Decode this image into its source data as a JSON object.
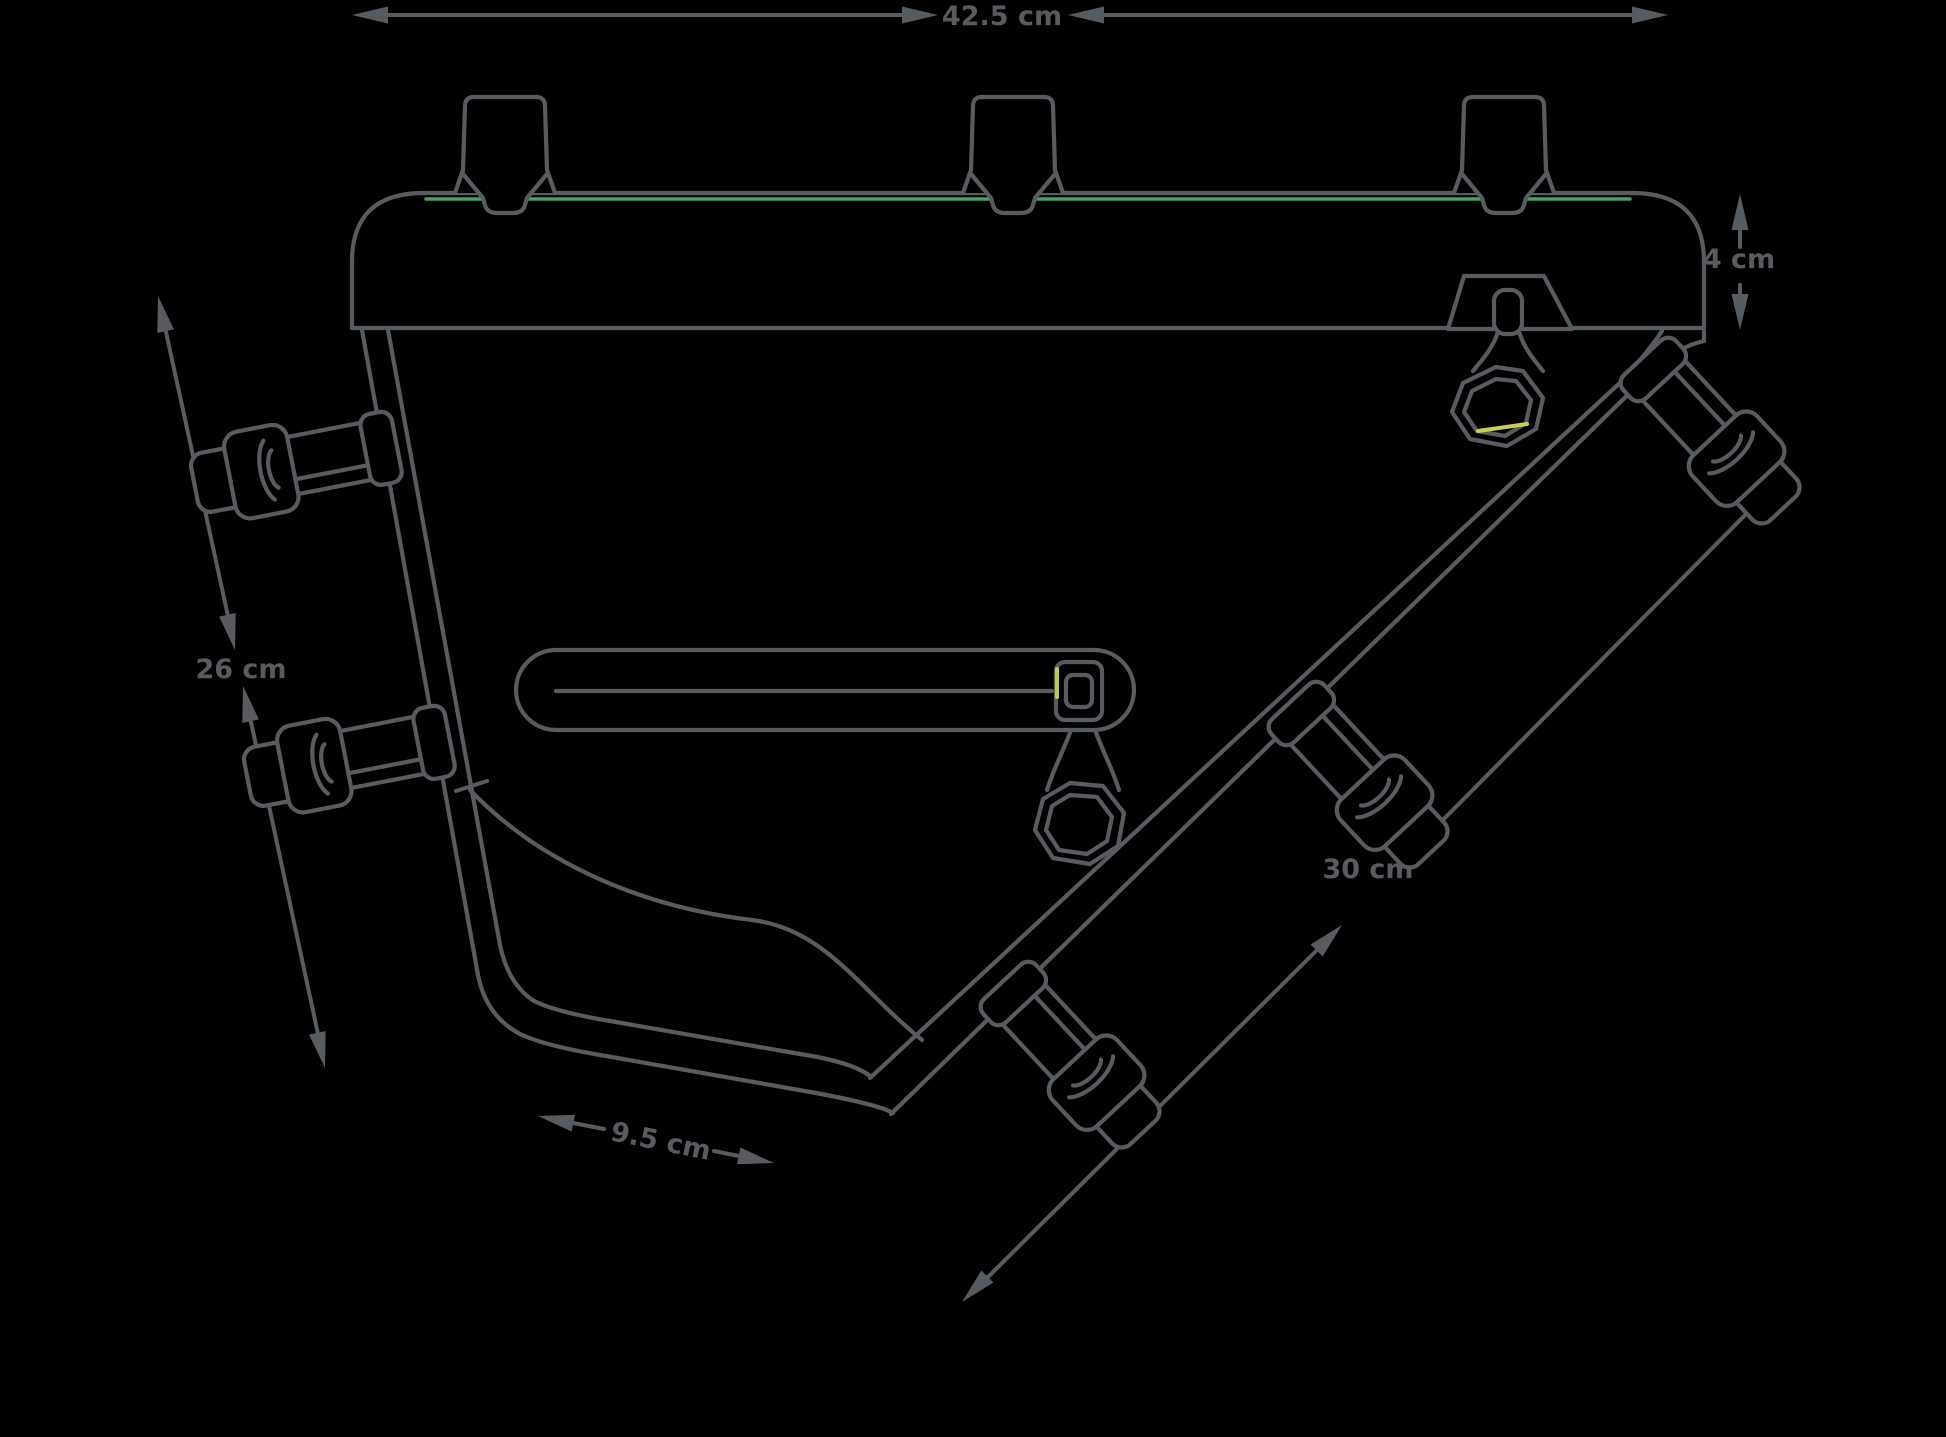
{
  "colors": {
    "background": "#000000",
    "line": "#575c61",
    "stitch_green": "#44a168",
    "stitch_yellow": "#c9cf52",
    "stitch_lime": "#b9cc4e"
  },
  "diagram": {
    "dimensions": {
      "top_width": {
        "label": "42.5 cm"
      },
      "lid_height": {
        "label": "4 cm"
      },
      "seat_tube_side": {
        "label": "26 cm"
      },
      "down_tube_side": {
        "label": "30 cm"
      },
      "bottom_width": {
        "label": "9.5 cm"
      }
    }
  }
}
